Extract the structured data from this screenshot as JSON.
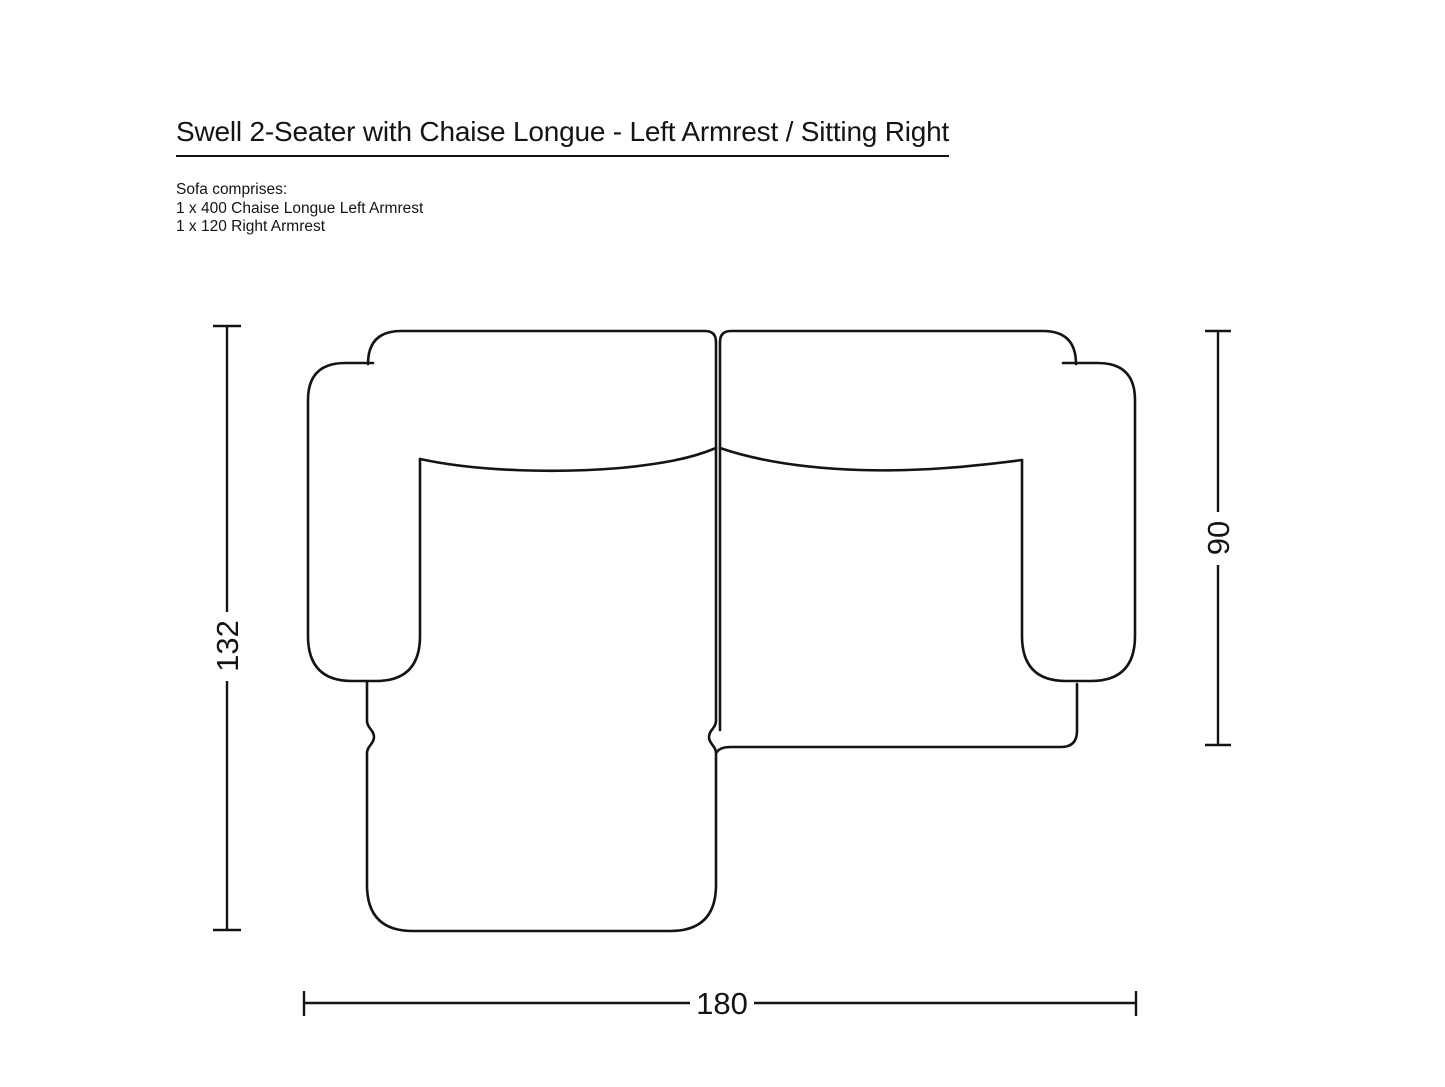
{
  "title": "Swell 2-Seater with Chaise Longue - Left Armrest / Sitting Right",
  "composition": {
    "intro": "Sofa comprises:",
    "items": [
      "1 x 400 Chaise Longue Left Armrest",
      "1 x 120 Right Armrest"
    ]
  },
  "diagram": {
    "type": "top-view-sofa-outline",
    "modules": [
      "Chaise Longue Left Armrest module",
      "Right Armrest seat module"
    ],
    "dimensions": {
      "total_depth": "132",
      "seat_depth": "90",
      "total_width": "180"
    },
    "ink_color": "#141414",
    "background_color": "#ffffff"
  }
}
